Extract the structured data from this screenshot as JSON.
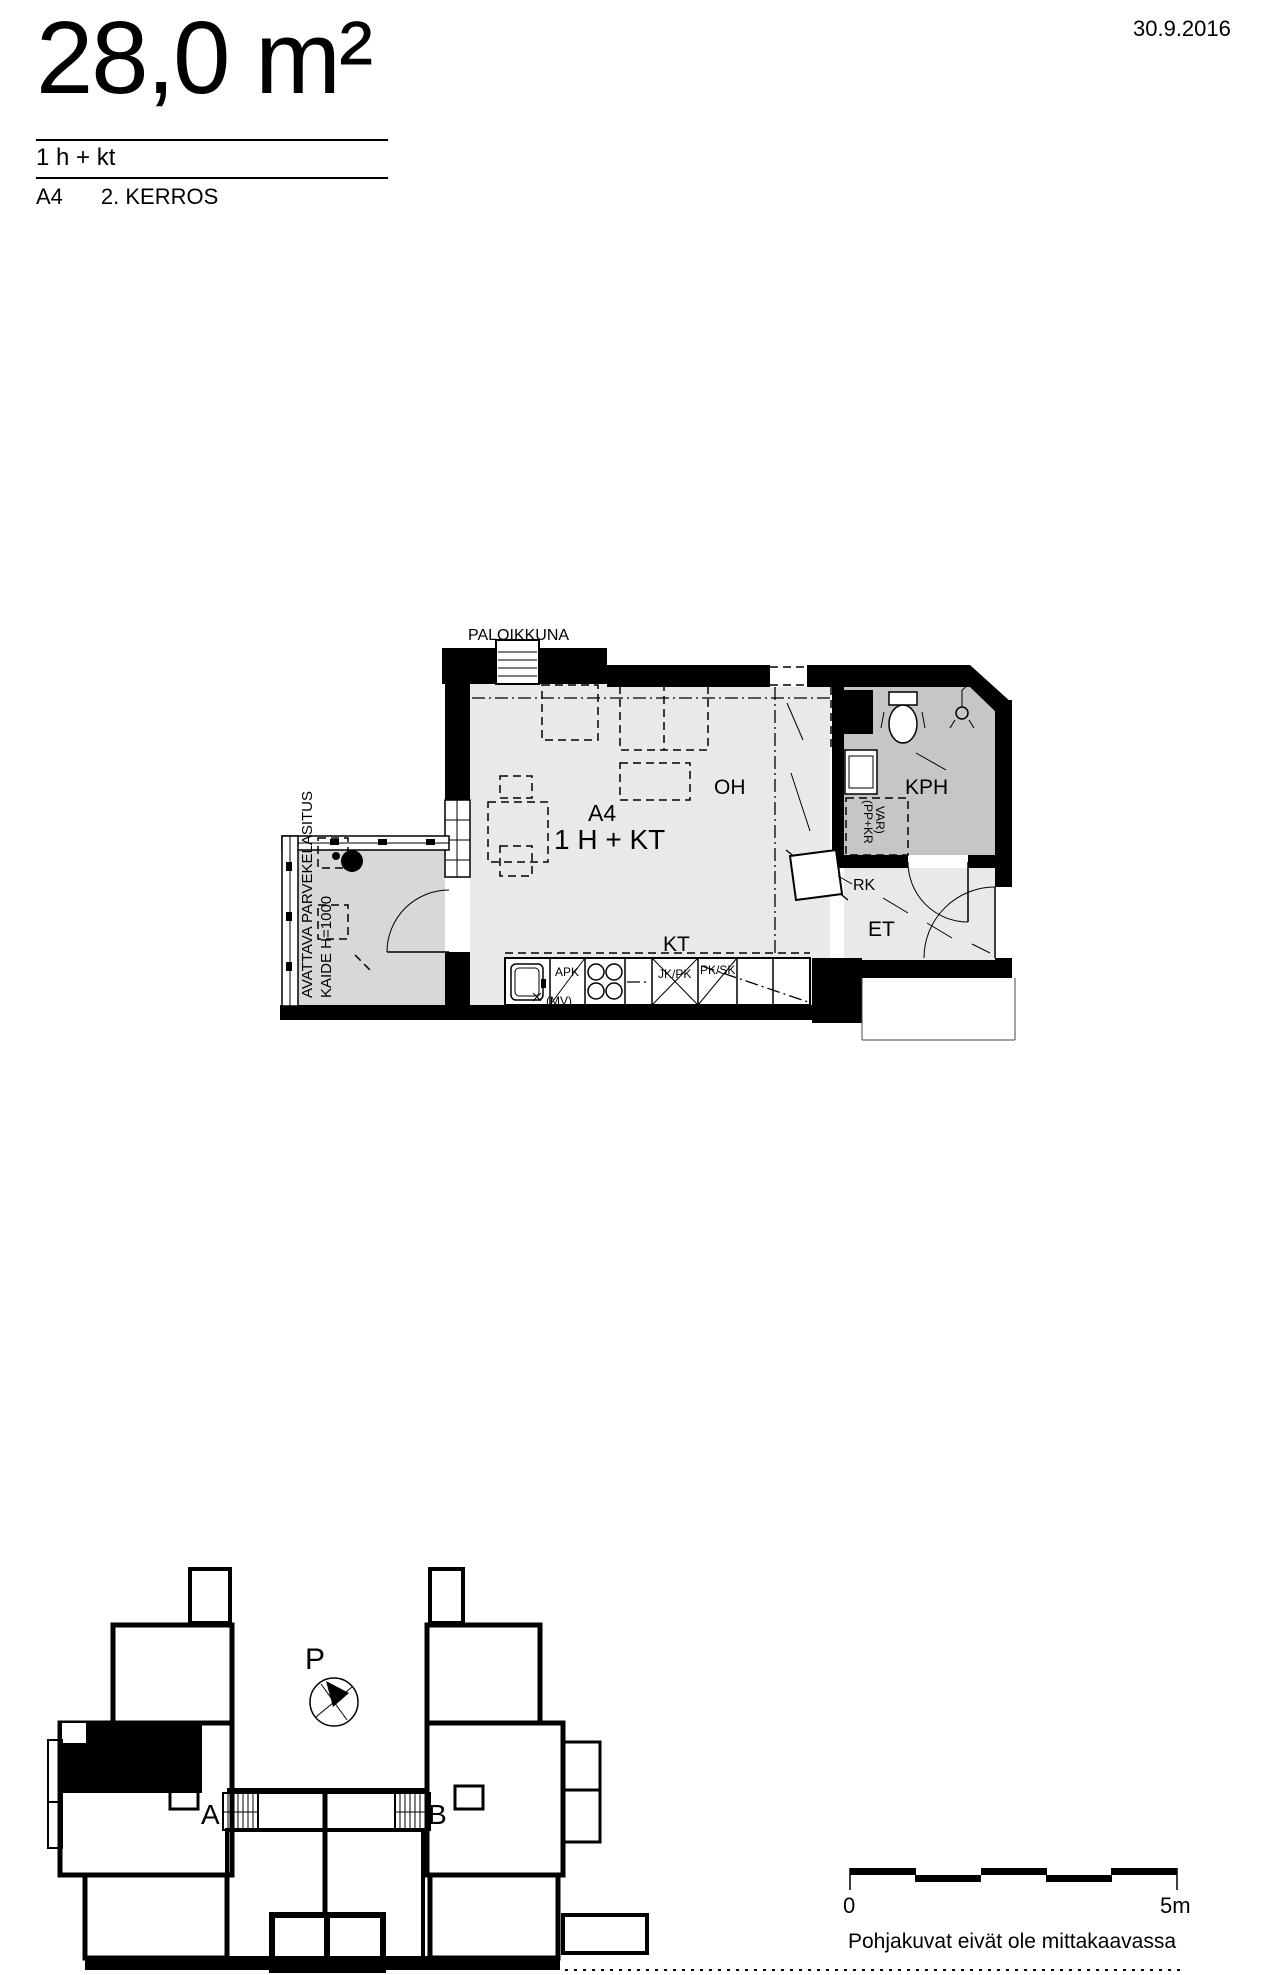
{
  "header": {
    "area": "28,0 m²",
    "room_config": "1 h + kt",
    "unit_id": "A4",
    "floor": "2. KERROS",
    "date": "30.9.2016"
  },
  "floor_plan": {
    "window_label": "PALOIKKUNA",
    "unit_label": "A4",
    "unit_type": "1 H + KT",
    "rooms": {
      "living": "OH",
      "kitchen": "KT",
      "hall": "ET",
      "bathroom": "KPH",
      "riser": "RK"
    },
    "balcony_note": {
      "line1": "AVATTAVA PARVEKELASITUS",
      "line2": "KAIDE H=1000"
    },
    "closet_note": {
      "line1": "(PP+KR",
      "line2": "VAR)"
    },
    "appliances": {
      "dishwasher": "APK",
      "microwave": "(MV)",
      "fridge": "JK/PK",
      "cabinet": "PK/SK"
    }
  },
  "site_plan": {
    "north": "P",
    "stair_a": "A",
    "stair_b": "B"
  },
  "scale_bar": {
    "start": "0",
    "end": "5m"
  },
  "disclaimer": "Pohjakuvat eivät ole mittakaavassa",
  "colors": {
    "background": "#ffffff",
    "walls": "#000000",
    "room_floor": "#e9e9e9",
    "bathroom_floor": "#c6c6c6",
    "balcony_floor": "#d8d8d8",
    "highlight_unit": "#000000"
  }
}
